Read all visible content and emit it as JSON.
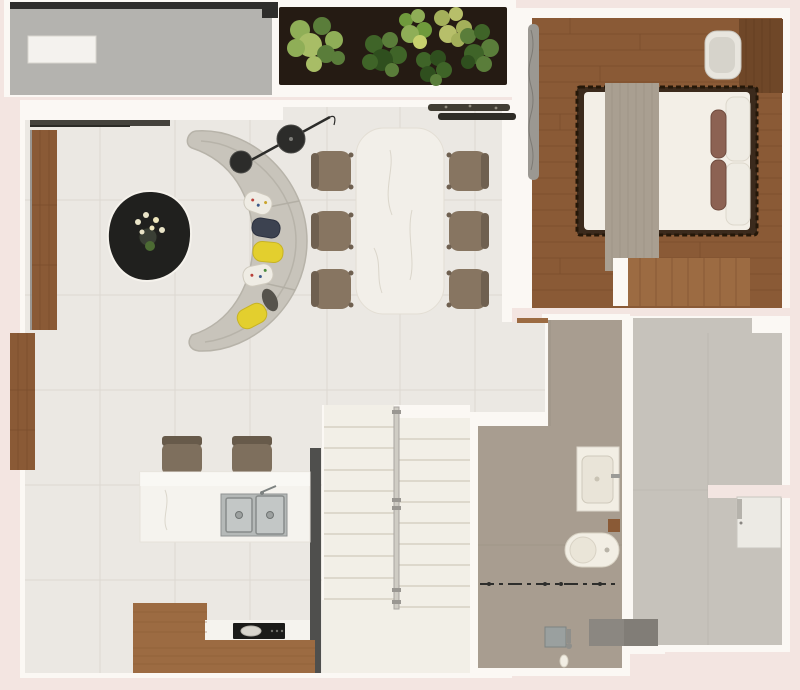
{
  "meta": {
    "type": "floor-plan-render",
    "view": "top-down-3d",
    "width_px": 800,
    "height_px": 690
  },
  "palette": {
    "bg": "#f3e5e1",
    "wall": "#fbf8f4",
    "tile": "#ebe8e3",
    "grout": "#dcd8d1",
    "balcony": "#b4b3af",
    "railing": "#2e2d2b",
    "bench": "#f4f2ee",
    "soil": "#251b13",
    "plantDark": "#3f6428",
    "plantMid": "#5a7d3a",
    "plantLight": "#8fae57",
    "plantYellow": "#a4b05a",
    "woodFloor": "#8a5a36",
    "woodSeam": "#77492b",
    "woodLight": "#9c6b42",
    "woodDark": "#6f4728",
    "bedFrame": "#3b2a1c",
    "duvet": "#f3efe7",
    "runner": "#a99f91",
    "pillowBrown": "#8c6253",
    "pillowWhite": "#efece4",
    "curtain": "#9b9892",
    "sofa": "#c8c4bb",
    "sofaShade": "#b3afa5",
    "tableBlack": "#20201e",
    "marble": "#f2efe9",
    "vein": "#d5cfc3",
    "chair": "#877561",
    "chairDark": "#6f6050",
    "stairs": "#f2efe7",
    "stepEdge": "#ddd8cc",
    "darkWall": "#4f4f4d",
    "island": "#f5f3ee",
    "steel": "#b5b9b8",
    "steelDark": "#8e9292",
    "cooktop": "#1b1b19",
    "bathFloor": "#a89d90",
    "fixture": "#f2eee4",
    "terrace": "#c6c2bb",
    "mat": "#8b8781",
    "glass": "#2e2e2c",
    "lamp": "#2c2c2a",
    "yellow": "#e3cf2e",
    "navy": "#3c4250"
  },
  "rooms": [
    {
      "name": "balcony",
      "furniture": [
        "railing",
        "bench",
        "planter-box-with-plants"
      ]
    },
    {
      "name": "living-room",
      "furniture": [
        "curved-sofa",
        "throw-pillows",
        "coffee-table",
        "flower-vase",
        "floor-lamp",
        "wall-cabinets"
      ]
    },
    {
      "name": "dining-area",
      "furniture": [
        "marble-dining-table",
        "dining-chairs",
        "console-decor"
      ]
    },
    {
      "name": "kitchen",
      "furniture": [
        "island-with-double-sink",
        "bar-stools",
        "l-shaped-wood-counter",
        "cooktop"
      ]
    },
    {
      "name": "bedroom",
      "furniture": [
        "double-bed",
        "bed-runner",
        "pillows",
        "desk",
        "desk-chair",
        "wardrobe",
        "curtain"
      ]
    },
    {
      "name": "bathroom",
      "furniture": [
        "washbasin",
        "toilet",
        "glass-partition",
        "shower-drain",
        "hand-shower"
      ]
    },
    {
      "name": "staircase",
      "furniture": [
        "left-flight",
        "right-flight",
        "glass-railing",
        "landing"
      ]
    },
    {
      "name": "terrace",
      "furniture": [
        "door",
        "entry-mat"
      ]
    }
  ],
  "counts": {
    "dining_chairs": 6,
    "bar_stools": 2,
    "stair_treads_per_flight": 10,
    "sofa_pillows": 5,
    "planter_plants": 6,
    "bed_pillows": 4
  }
}
